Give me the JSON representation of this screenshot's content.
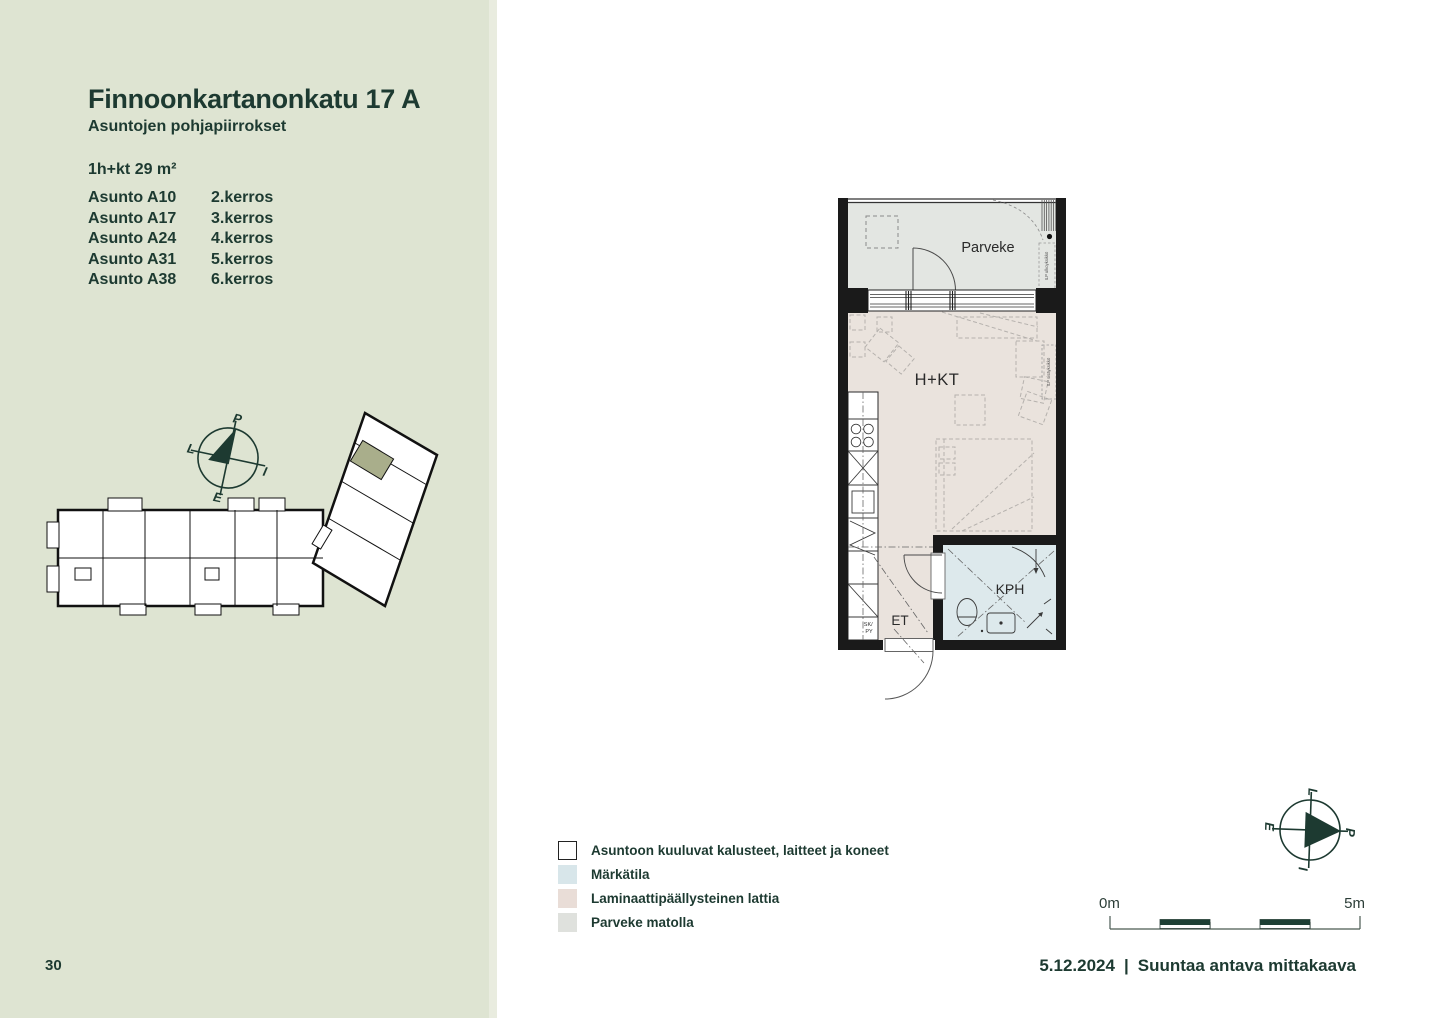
{
  "page": {
    "number": "30",
    "date": "5.12.2024",
    "divider": "|",
    "scale_note": "Suuntaa antava mittakaava"
  },
  "sidebar": {
    "title": "Finnoonkartanonkatu 17 A",
    "subtitle": "Asuntojen pohjapiirrokset",
    "unit_type": "1h+kt 29 m²",
    "apartments": [
      {
        "name": "Asunto A10",
        "floor": "2.kerros"
      },
      {
        "name": "Asunto A17",
        "floor": "3.kerros"
      },
      {
        "name": "Asunto A24",
        "floor": "4.kerros"
      },
      {
        "name": "Asunto A31",
        "floor": "5.kerros"
      },
      {
        "name": "Asunto A38",
        "floor": "6.kerros"
      }
    ]
  },
  "floorplan": {
    "rooms": {
      "balcony": "Parveke",
      "living": "H+KT",
      "bathroom": "KPH",
      "entry": "ET"
    },
    "annotations": {
      "closet": [
        "SK/",
        "PY"
      ],
      "outdoor_unit": "ILP ulkoyksikkö",
      "indoor_unit": "ILP sisäyksikkö"
    }
  },
  "compass": {
    "north": "P",
    "east": "I",
    "south": "E",
    "west": "L"
  },
  "legend": [
    {
      "label": "Asuntoon kuuluvat kalusteet, laitteet ja koneet",
      "swatch": "#ffffff"
    },
    {
      "label": "Märkätila",
      "swatch": "#d8e6ea"
    },
    {
      "label": "Laminaattipäällysteinen lattia",
      "swatch": "#e9ddd7"
    },
    {
      "label": "Parveke matolla",
      "swatch": "#dfe1dd"
    }
  ],
  "scalebar": {
    "start": "0m",
    "end": "5m"
  },
  "colors": {
    "sidebar_bg": "#dee4d2",
    "accent_dark": "#1d3a31",
    "wall": "#1a1a1a",
    "floor_laminate": "#eae3dd",
    "wet_room": "#dde9ec",
    "balcony_mat": "#e3e6e2",
    "keyplan_highlight": "#a9ae8b"
  }
}
